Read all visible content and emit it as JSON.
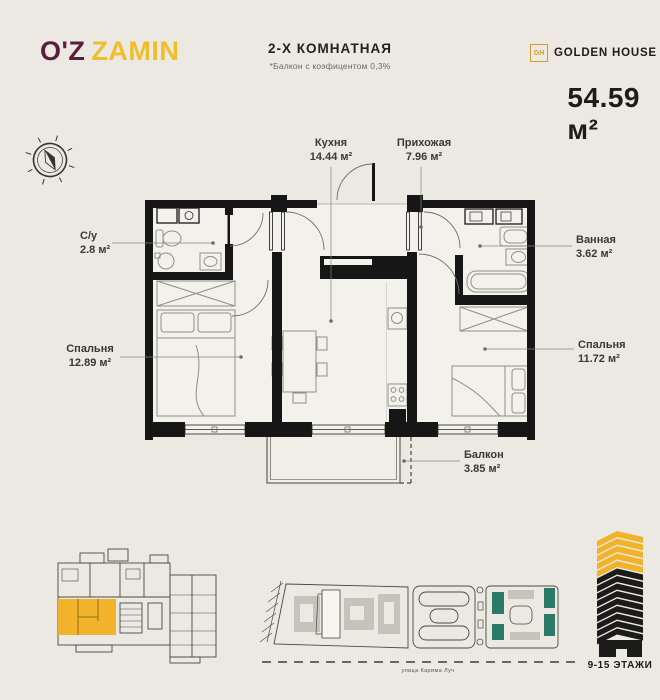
{
  "header": {
    "logo_part1": "O'Z",
    "logo_part2": "ZAMIN",
    "title": "2-Х КОМНАТНАЯ",
    "subtitle": "*Балкон с коэфицентом 0,3%",
    "brand_icon": "GH",
    "brand_name": "GOLDEN HOUSE",
    "total_area": "54.59 м²"
  },
  "plan": {
    "rooms": [
      {
        "id": "kitchen",
        "name": "Кухня",
        "area": "14.44 м²"
      },
      {
        "id": "hallway",
        "name": "Прихожая",
        "area": "7.96 м²"
      },
      {
        "id": "wc",
        "name": "С/у",
        "area": "2.8 м²"
      },
      {
        "id": "bedroom_left",
        "name": "Спальня",
        "area": "12.89 м²"
      },
      {
        "id": "bathroom",
        "name": "Ванная",
        "area": "3.62 м²"
      },
      {
        "id": "bedroom_right",
        "name": "Спальня",
        "area": "11.72 м²"
      },
      {
        "id": "balcony",
        "name": "Балкон",
        "area": "3.85 м²"
      }
    ]
  },
  "footer": {
    "street_label": "улица Карима Луч",
    "floors_label": "9-15 ЭТАЖИ"
  },
  "colors": {
    "background": "#ECE9E2",
    "accent_yellow": "#F1B32B",
    "logo_maroon": "#5B1F3E",
    "brand_gold": "#D89A33",
    "wall_black": "#161616",
    "site_teal": "#2B7A68"
  }
}
